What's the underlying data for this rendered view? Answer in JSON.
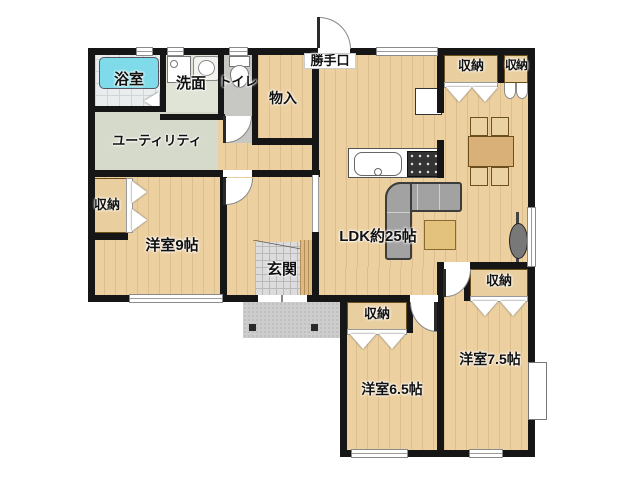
{
  "floorplan": {
    "labels": {
      "bath": "浴室",
      "washroom": "洗面",
      "toilet": "トイレ",
      "utility": "ユーティリティ",
      "storage": "物入",
      "backdoor": "勝手口",
      "bedroom9": "洋室9帖",
      "entrance": "玄関",
      "ldk": "LDK約25帖",
      "bedroom65": "洋室6.5帖",
      "bedroom75": "洋室7.5帖"
    },
    "closets": [
      "収納",
      "収納",
      "収納",
      "収納",
      "収納"
    ],
    "colors": {
      "wall": "#161616",
      "wood_floor": "#ecd0a0",
      "bathtub": "#7fdbe9",
      "closet_fill": "#e9cf9f",
      "entrance_tile": "#dcdcdc",
      "sofa": "#a2a2a2",
      "table_wood": "#d9b077"
    }
  }
}
